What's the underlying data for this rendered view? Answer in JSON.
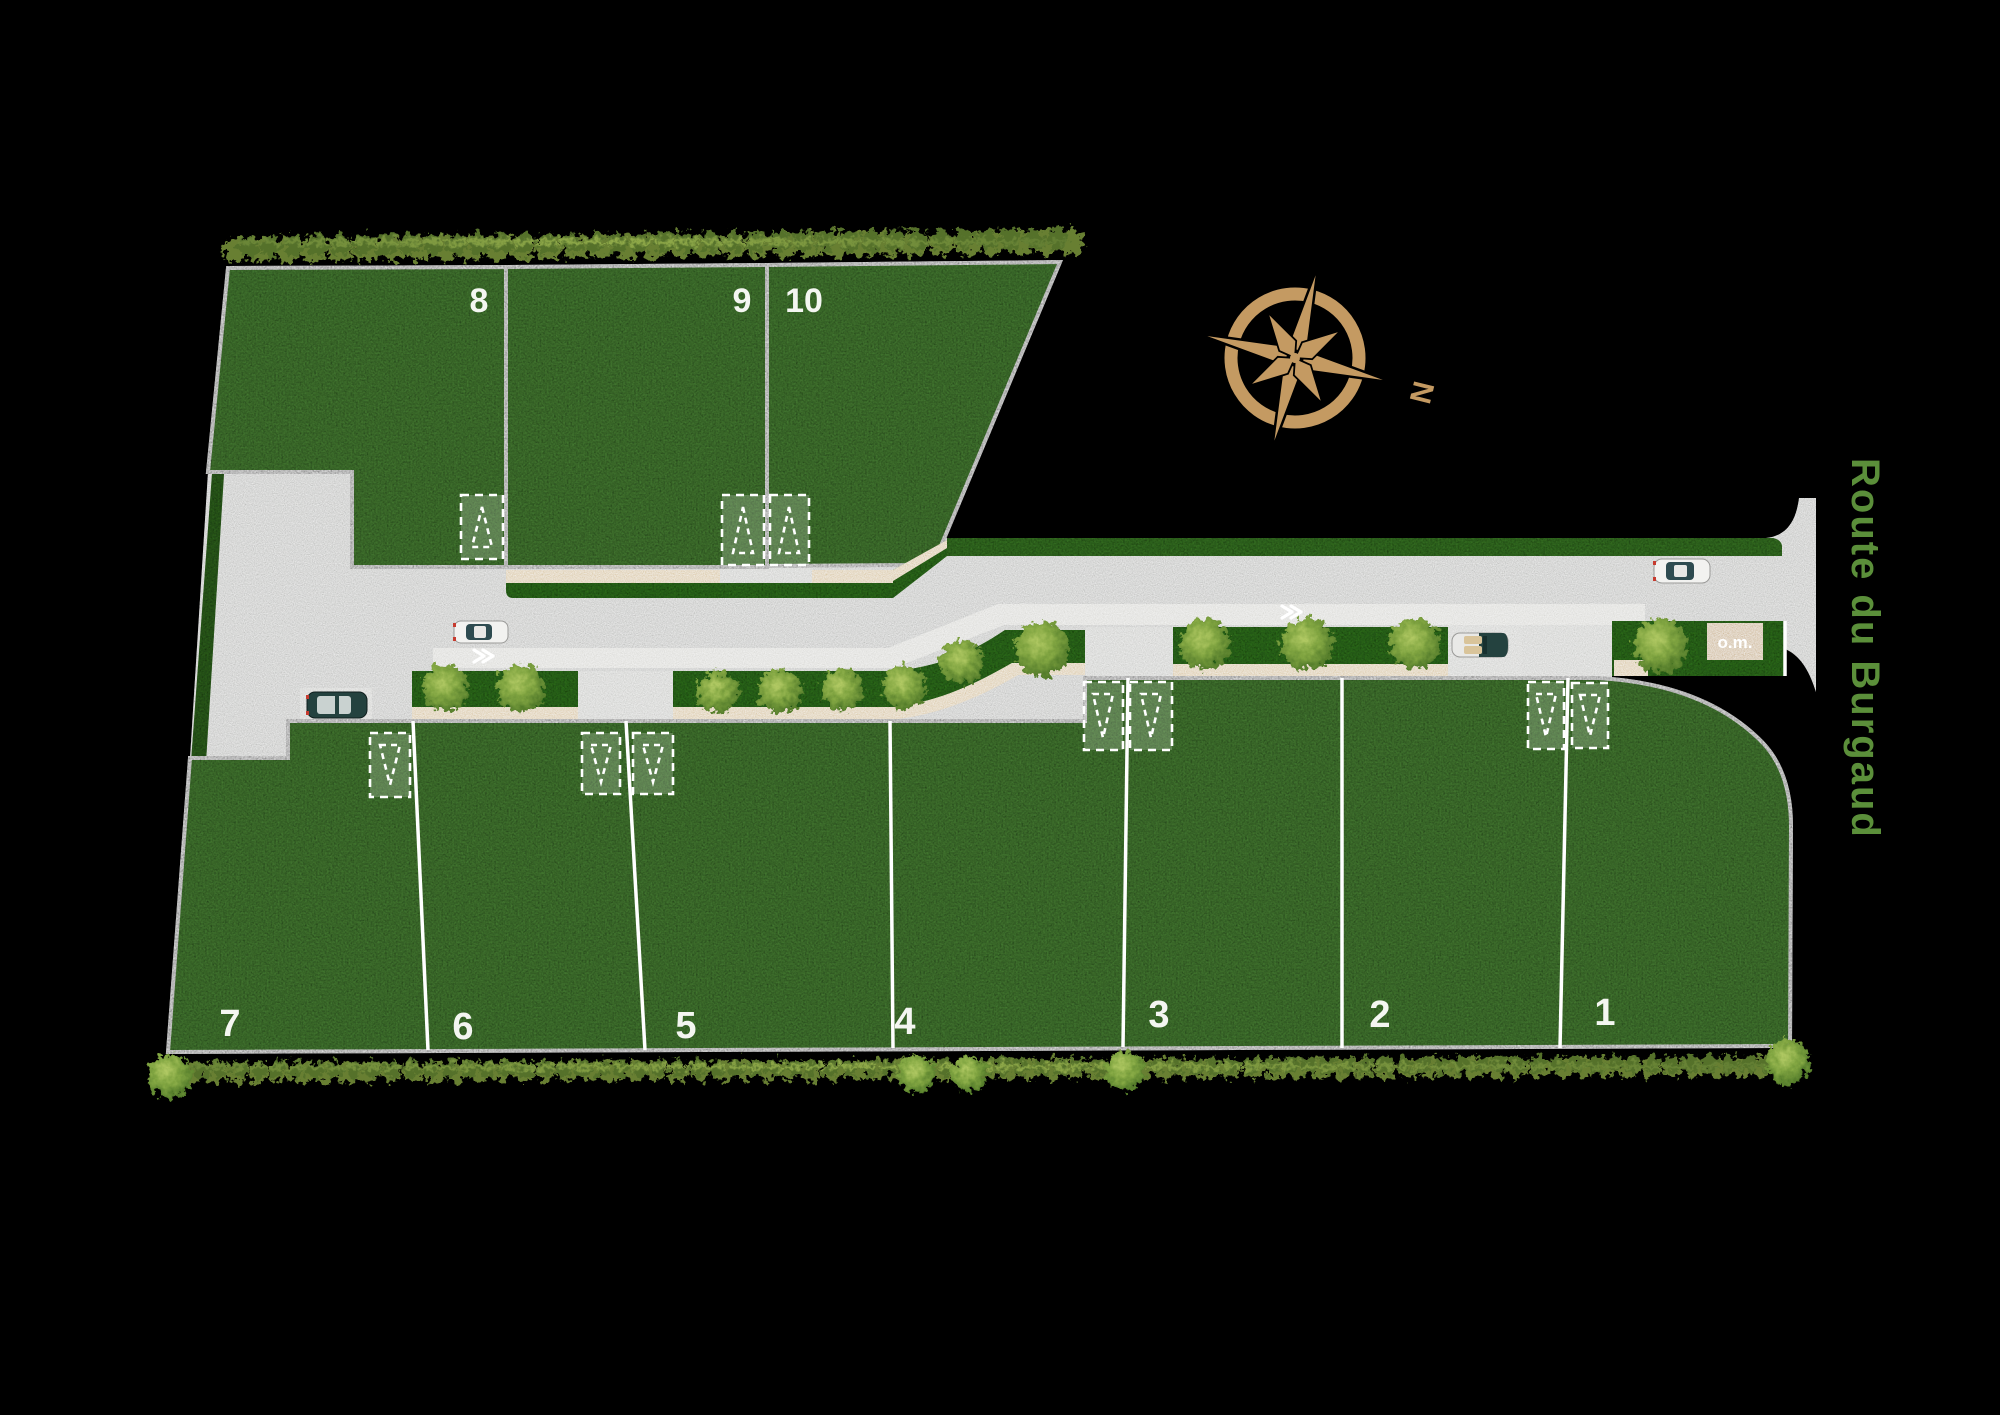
{
  "plan": {
    "north_label": "N",
    "road_name": "Route du Burgaud",
    "om_label": "o.m.",
    "lots": [
      {
        "label": "1"
      },
      {
        "label": "2"
      },
      {
        "label": "3"
      },
      {
        "label": "4"
      },
      {
        "label": "5"
      },
      {
        "label": "6"
      },
      {
        "label": "7"
      },
      {
        "label": "8"
      },
      {
        "label": "9"
      },
      {
        "label": "10"
      }
    ]
  },
  "colors": {
    "background": "#000000",
    "lot_grass": "#4f8c3a",
    "verge_grass": "#368021",
    "road_gray": "#b9bab8",
    "lane_gray": "#dadad6",
    "driveway_gray": "#c6c7c4",
    "path_tan": "#d6c29b",
    "om_tan": "#c9b089",
    "line_white": "#ffffff",
    "label_white": "#f4f6f1",
    "compass_gold": "#c49a62",
    "route_text_green": "#5b8f3a",
    "hedge_olive": "#7d9a40"
  }
}
